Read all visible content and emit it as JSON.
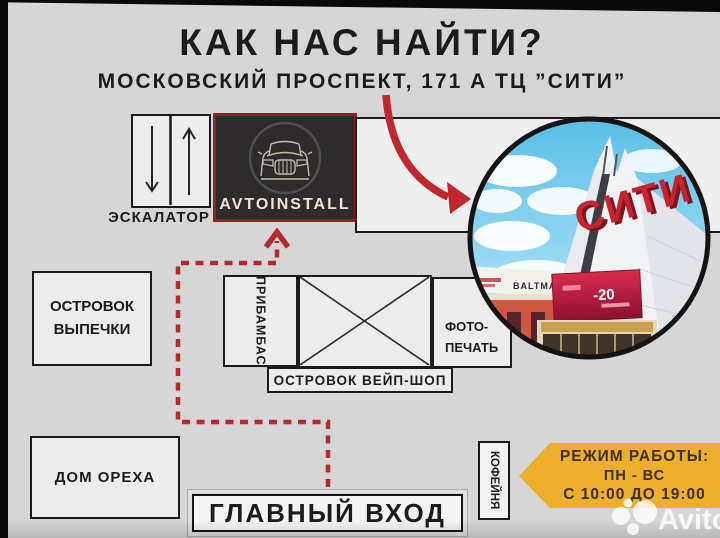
{
  "header": {
    "title": "КАК НАС НАЙТИ?",
    "subtitle": "МОСКОВСКИЙ ПРОСПЕКТ, 171 А ТЦ ”СИТИ”"
  },
  "map": {
    "escalator_label": "ЭСКАЛАТОР",
    "store_name": "AVTOINSTALL",
    "bakery_line1": "ОСТРОВОК",
    "bakery_line2": "ВЫПЕЧКИ",
    "pribambas": "ПРИБАМБАС",
    "photo_print_line1": "ФОТО-",
    "photo_print_line2": "ПЕЧАТЬ",
    "vape_island": "ОСТРОВОК ВЕЙП-ШОП",
    "nut_house": "ДОМ ОРЕХА",
    "main_entrance": "ГЛАВНЫЙ ВХОД",
    "coffee_shop": "КОФЕЙНЯ"
  },
  "photo": {
    "mall_sign": "СИТИ",
    "facade_text": "BALTMAXIMUS.",
    "led_text": "-20"
  },
  "hours": {
    "line1": "РЕЖИМ РАБОТЫ:",
    "line2": "ПН - ВС",
    "line3": "С 10:00 ДО 19:00"
  },
  "watermark": {
    "brand": "Avito"
  },
  "colors": {
    "accent_red": "#c1272d",
    "path_red": "#b52a2b",
    "banner_yellow": "#edb02d",
    "store_bg": "#2d2b2c",
    "store_border": "#9c1d20",
    "store_text": "#ece4d0",
    "sign_red": "#c52531",
    "background": "#d6d6d6"
  }
}
